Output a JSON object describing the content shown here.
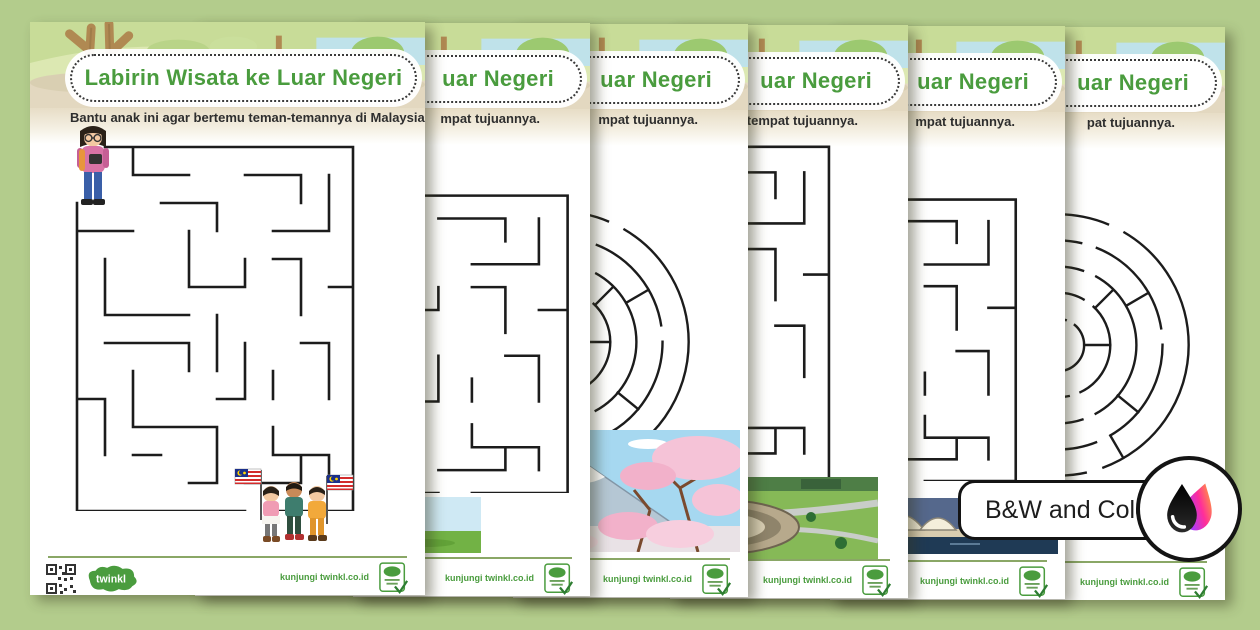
{
  "app": {
    "background_color": "#b3cc8c",
    "accent_green": "#4a9c3e",
    "maze_stroke": "#1c1c1c"
  },
  "badge": {
    "label": "B&W and Color",
    "icon": "ink-drops-icon"
  },
  "footer": {
    "visit_text": "kunjungi twinkl.co.id",
    "logo_text": "twinkl"
  },
  "pages": [
    {
      "title": "Labirin Wisata ke Luar Negeri",
      "subtitle": "Bantu anak ini agar bertemu teman-temannya di Malaysia.",
      "maze": "rectangular",
      "scene_start": "traveler-girl",
      "scene_end": "kids-with-malaysian-flags"
    },
    {
      "title": "uar Negeri",
      "subtitle": "mpat tujuannya.",
      "maze": "rectangular",
      "scene_end": "city-skyline"
    },
    {
      "title": "uar Negeri",
      "subtitle": "mpat tujuannya.",
      "maze": "circular",
      "scene_end": "mount-fuji-cherry-blossoms"
    },
    {
      "title": "uar Negeri",
      "subtitle": "i di tempat tujuannya.",
      "maze": "rectangular",
      "scene_end": "park-aerial-view"
    },
    {
      "title": "uar Negeri",
      "subtitle": "mpat tujuannya.",
      "maze": "rectangular",
      "scene_end": "sydney-opera-house"
    },
    {
      "title": "uar Negeri",
      "subtitle": "pat tujuannya.",
      "maze": "circular",
      "scene_end": null
    }
  ]
}
